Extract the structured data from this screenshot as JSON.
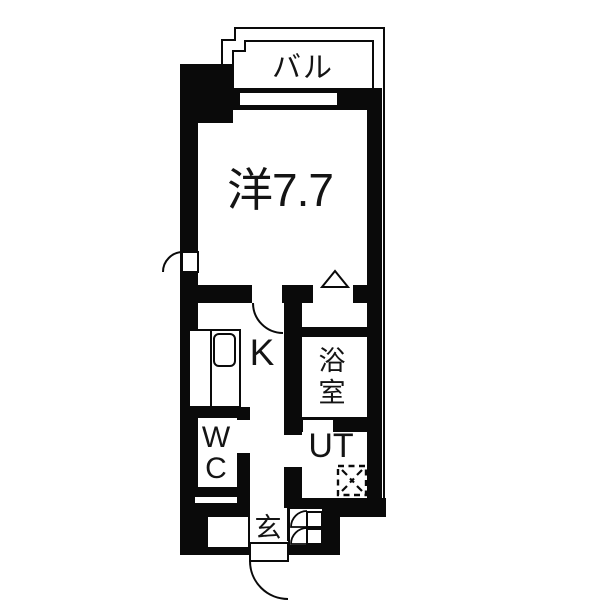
{
  "floorplan": {
    "rooms": {
      "balcony": {
        "label": "バル"
      },
      "western_room": {
        "label": "洋7.7"
      },
      "kitchen": {
        "label": "K"
      },
      "bathroom": {
        "char1": "浴",
        "char2": "室"
      },
      "toilet": {
        "char1": "W",
        "char2": "C"
      },
      "utility": {
        "label": "UT"
      },
      "entrance": {
        "label": "玄"
      }
    },
    "colors": {
      "wall": "#0a0a0a",
      "background": "#ffffff"
    }
  }
}
